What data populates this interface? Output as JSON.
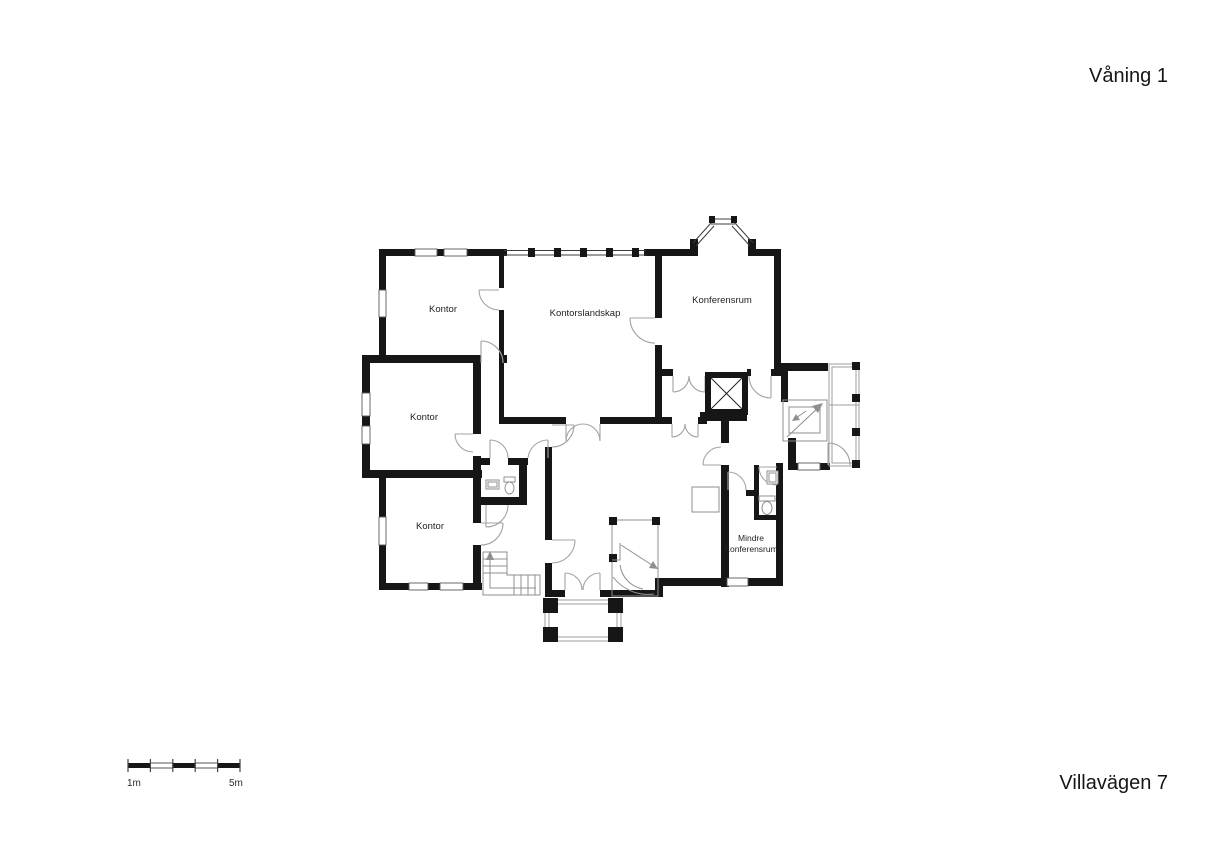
{
  "titles": {
    "floor": "Våning 1",
    "address": "Villavägen 7"
  },
  "rooms": {
    "kontor_nw": "Kontor",
    "kontorslandskap": "Kontorslandskap",
    "konferensrum": "Konferensrum",
    "kontor_w": "Kontor",
    "kontor_sw": "Kontor",
    "mindre_line1": "Mindre",
    "mindre_line2": "Konferensrum"
  },
  "scale_bar": {
    "start_label": "1m",
    "end_label": "5m"
  },
  "colors": {
    "wall": "#161616",
    "door_arc": "#a3a3a3",
    "fixture_stroke": "#8f8f8f",
    "background": "#ffffff",
    "label_text": "#1f1f1f"
  },
  "elements": {
    "elevator": "elevator-shaft",
    "stairs": [
      "straight-stair-ne",
      "curved-stair-hall",
      "l-stair-sw"
    ],
    "fixtures": [
      "wc-toilet-left",
      "wc-sink-left",
      "wc-toilet-right",
      "wc-sink-right"
    ],
    "outdoor": [
      "entrance-porch",
      "side-deck",
      "bay-window"
    ]
  }
}
